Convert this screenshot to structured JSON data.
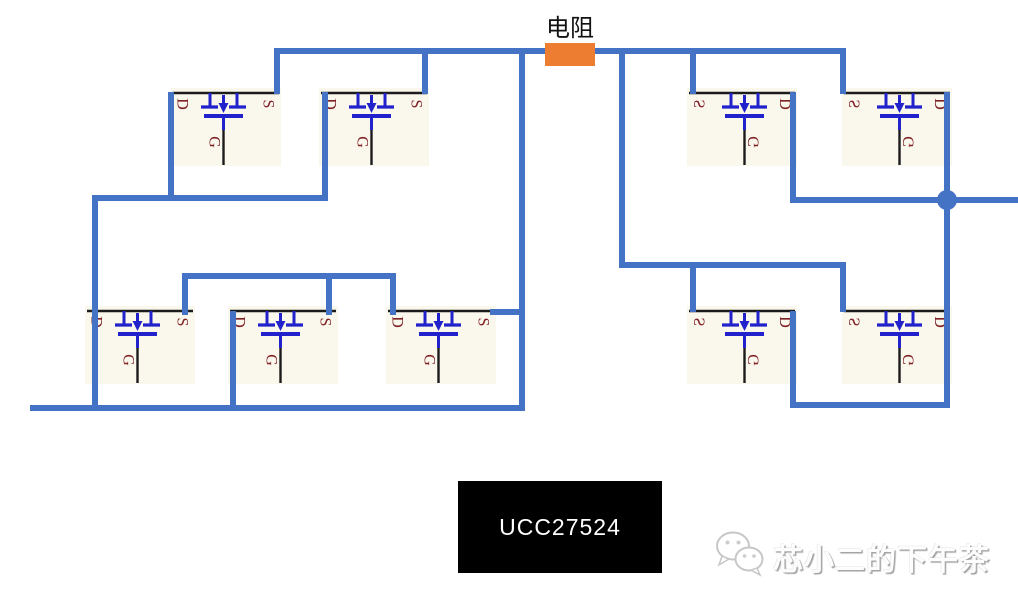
{
  "diagram": {
    "resistor_label": "电阻",
    "chip_label": "UCC27524",
    "watermark_text": "芯小二的下午茶",
    "mosfet_labels": {
      "drain": "D",
      "gate": "G",
      "source": "S"
    },
    "colors": {
      "wire": "#4472C4",
      "resistor": "#ED7D31",
      "mosfet_symbol": "#2222CC",
      "mosfet_pin_text": "#7F2125",
      "mosfet_box_bg": "#FAF7EC",
      "chip_bg": "#000000",
      "chip_text": "#FFFFFF"
    },
    "resistor": {
      "x": 545,
      "y": 43,
      "w": 50,
      "h": 23
    },
    "resistor_label_pos": {
      "x": 510,
      "y": 8
    },
    "junction": {
      "cx": 947,
      "cy": 200,
      "r": 10
    },
    "chip": {
      "x": 458,
      "y": 481,
      "w": 204,
      "h": 92
    },
    "transistors": [
      {
        "id": "q1-top-left-1",
        "x": 171,
        "y": 88,
        "mirrored": false
      },
      {
        "id": "q2-top-left-2",
        "x": 319,
        "y": 88,
        "mirrored": false
      },
      {
        "id": "q3-top-right-1",
        "x": 687,
        "y": 88,
        "mirrored": true
      },
      {
        "id": "q4-top-right-2",
        "x": 842,
        "y": 88,
        "mirrored": true
      },
      {
        "id": "q5-bottom-left-1",
        "x": 85,
        "y": 306,
        "mirrored": false
      },
      {
        "id": "q6-bottom-left-2",
        "x": 228,
        "y": 306,
        "mirrored": false
      },
      {
        "id": "q7-bottom-left-3",
        "x": 386,
        "y": 306,
        "mirrored": false
      },
      {
        "id": "q8-bottom-right-1",
        "x": 687,
        "y": 306,
        "mirrored": true
      },
      {
        "id": "q9-bottom-right-2",
        "x": 842,
        "y": 306,
        "mirrored": true
      }
    ],
    "wires": [
      {
        "x": 274,
        "y": 48,
        "w": 572,
        "h": 6
      },
      {
        "x": 274,
        "y": 48,
        "w": 6,
        "h": 46
      },
      {
        "x": 422,
        "y": 48,
        "w": 6,
        "h": 46
      },
      {
        "x": 519,
        "y": 48,
        "w": 6,
        "h": 360
      },
      {
        "x": 619,
        "y": 48,
        "w": 6,
        "h": 217
      },
      {
        "x": 690,
        "y": 48,
        "w": 6,
        "h": 46
      },
      {
        "x": 840,
        "y": 48,
        "w": 6,
        "h": 46
      },
      {
        "x": 168,
        "y": 92,
        "w": 6,
        "h": 109
      },
      {
        "x": 322,
        "y": 92,
        "w": 6,
        "h": 109
      },
      {
        "x": 92,
        "y": 195,
        "w": 236,
        "h": 6
      },
      {
        "x": 92,
        "y": 195,
        "w": 6,
        "h": 216
      },
      {
        "x": 30,
        "y": 405,
        "w": 495,
        "h": 6
      },
      {
        "x": 182,
        "y": 273,
        "w": 214,
        "h": 6
      },
      {
        "x": 182,
        "y": 273,
        "w": 6,
        "h": 42
      },
      {
        "x": 326,
        "y": 273,
        "w": 6,
        "h": 42
      },
      {
        "x": 390,
        "y": 273,
        "w": 6,
        "h": 42
      },
      {
        "x": 230,
        "y": 311,
        "w": 6,
        "h": 100
      },
      {
        "x": 490,
        "y": 309,
        "w": 35,
        "h": 6
      },
      {
        "x": 619,
        "y": 262,
        "w": 227,
        "h": 6
      },
      {
        "x": 690,
        "y": 262,
        "w": 6,
        "h": 50
      },
      {
        "x": 840,
        "y": 262,
        "w": 6,
        "h": 50
      },
      {
        "x": 790,
        "y": 92,
        "w": 6,
        "h": 111
      },
      {
        "x": 790,
        "y": 197,
        "w": 228,
        "h": 6
      },
      {
        "x": 944,
        "y": 92,
        "w": 6,
        "h": 316
      },
      {
        "x": 790,
        "y": 402,
        "w": 160,
        "h": 6
      },
      {
        "x": 790,
        "y": 311,
        "w": 6,
        "h": 97
      }
    ]
  }
}
